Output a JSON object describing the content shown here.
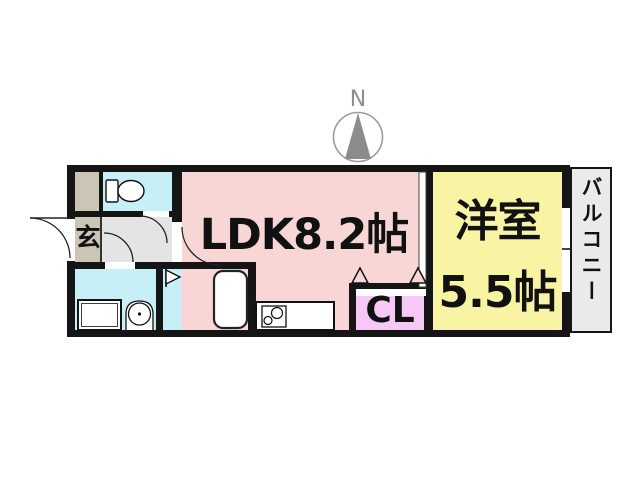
{
  "compass": {
    "label": "N"
  },
  "rooms": {
    "ldk": {
      "label": "LDK8.2帖",
      "color": "#f9d6d6"
    },
    "western": {
      "label_line1": "洋室",
      "label_line2": "5.5帖",
      "color": "#f8f4a4"
    },
    "balcony": {
      "label": "バルコニー",
      "color": "#eaeaea"
    },
    "genkan": {
      "label": "玄",
      "color": "#cbc5b5"
    },
    "storage": {
      "color": "#cbc5b5"
    },
    "hallway": {
      "color": "#e4e4e4"
    },
    "toilet_room": {
      "color": "#c7eff8"
    },
    "washroom": {
      "color": "#c7eff8"
    },
    "bathroom": {
      "color": "#c7eff8"
    },
    "closet": {
      "label": "CL",
      "color": "#f6c8f6"
    },
    "laundry": {
      "label": "洗濯機置き場"
    }
  },
  "fixtures": {
    "toilet": "toilet",
    "washbasin": "washbasin",
    "washing_machine": "washing-machine-area",
    "bathtub": "bathtub",
    "stove": "kitchen-stove",
    "folding_door": "bathroom-folding-door",
    "closet_doors": "closet-folding-doors",
    "entrance_door": "entrance-door"
  },
  "palette": {
    "wall": "#151515",
    "compass_gray": "#8c8c8c",
    "compass_ring": "#9c9c9c"
  }
}
